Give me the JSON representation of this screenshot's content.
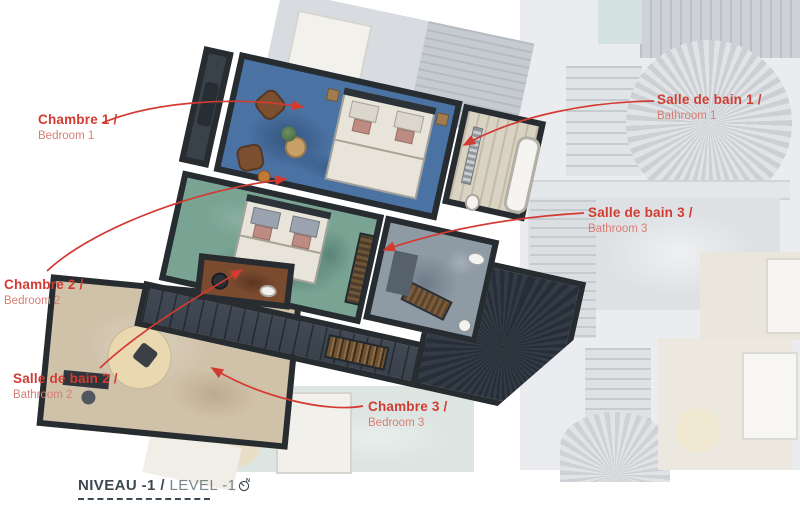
{
  "title": {
    "fr": "NIVEAU -1 /",
    "en": "LEVEL -1"
  },
  "labels": [
    {
      "id": "chambre-1",
      "fr": "Chambre 1 /",
      "en": "Bedroom 1"
    },
    {
      "id": "salle-de-bain-1",
      "fr": "Salle de bain 1 /",
      "en": "Bathroom 1"
    },
    {
      "id": "salle-de-bain-3",
      "fr": "Salle de bain 3 /",
      "en": "Bathroom 3"
    },
    {
      "id": "chambre-2",
      "fr": "Chambre 2 /",
      "en": "Bedroom 2"
    },
    {
      "id": "salle-de-bain-2",
      "fr": "Salle de bain 2 /",
      "en": "Bathroom 2"
    },
    {
      "id": "chambre-3",
      "fr": "Chambre 3 /",
      "en": "Bedroom 3"
    }
  ],
  "colors": {
    "accent": "#d23b32",
    "accent_soft": "#d97e74",
    "title": "#3c4950",
    "title_light": "#77858d",
    "floor_bedroom1": "#4a72a3",
    "floor_bedroom2": "#79a494",
    "floor_bedroom3": "#d0c1a9",
    "floor_bathroom2": "#7b4b30",
    "floor_bathroom3": "#8e9aa4",
    "walls": "#272c31"
  },
  "icons": {
    "compass": "north-compass-icon"
  }
}
